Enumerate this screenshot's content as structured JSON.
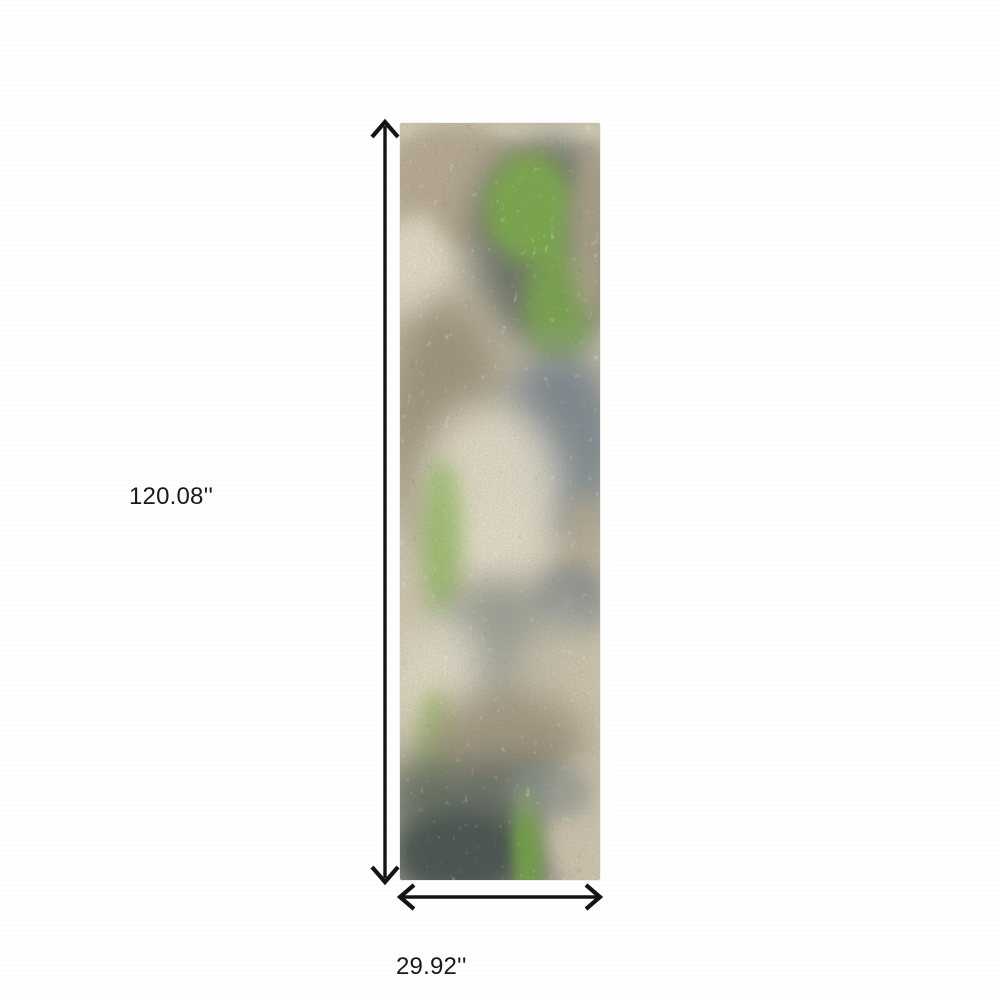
{
  "page": {
    "background_color": "#ffffff",
    "kind": "product dimension image"
  },
  "product": {
    "type": "runner rug",
    "description": "Abstract distressed runner rug in beige, taupe, slate grey and green",
    "colors": {
      "base_beige": "#cdc4ae",
      "cream": "#e5decb",
      "tan": "#b3a78f",
      "taupe": "#978c77",
      "slate_grey": "#77838c",
      "grey_green": "#5f675f",
      "mid_grey": "#8e958e",
      "charcoal": "#47524f",
      "accent_green": "#7fb347",
      "deep_green": "#74a647"
    }
  },
  "dimensions": {
    "height_label": "120.08''",
    "width_label": "29.92''",
    "line_color": "#141414"
  }
}
